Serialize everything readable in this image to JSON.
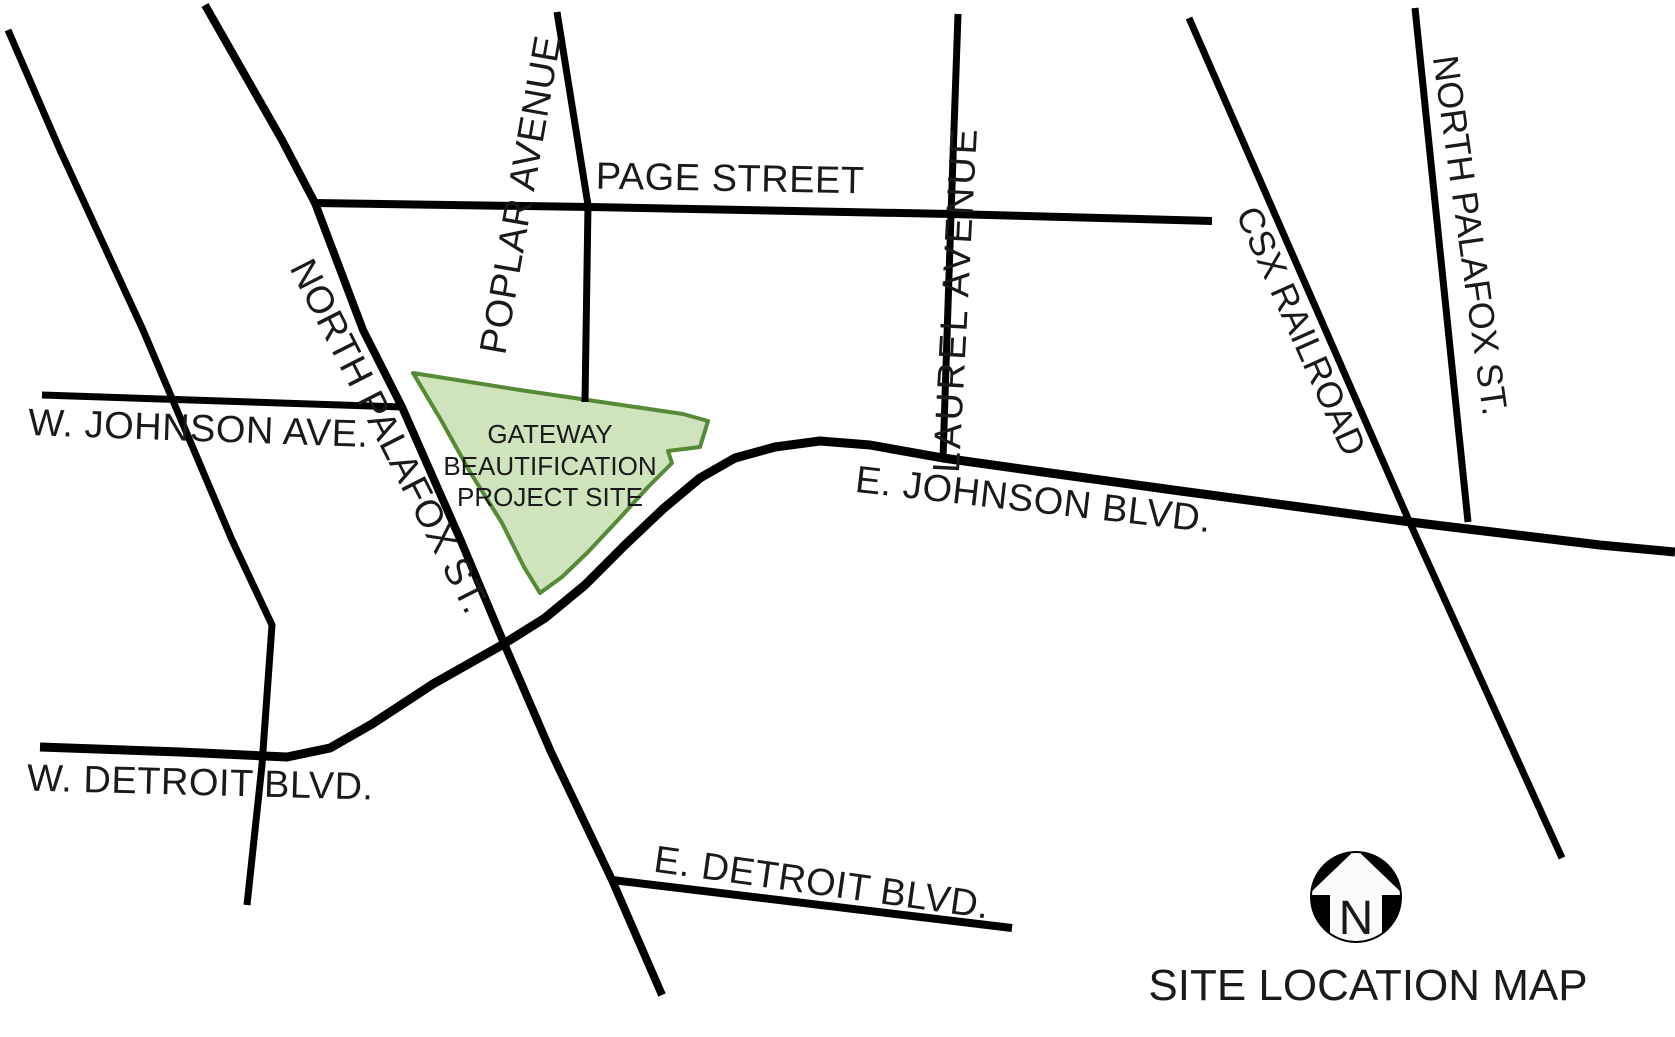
{
  "map": {
    "title": "SITE LOCATION MAP",
    "compass": {
      "letter": "N",
      "name": "north-arrow"
    },
    "site": {
      "line1": "GATEWAY",
      "line2": "BEAUTIFICATION",
      "line3": "PROJECT SITE"
    },
    "streets": {
      "page": "PAGE STREET",
      "poplar": "POPLAR AVENUE",
      "laurel": "LAUREL AVENUE",
      "csx": "CSX RAILROAD",
      "north_palafox_west": "NORTH PALAFOX ST.",
      "north_palafox_east": "NORTH PALAFOX ST.",
      "w_johnson": "W. JOHNSON AVE.",
      "e_johnson": "E. JOHNSON BLVD.",
      "w_detroit": "W. DETROIT BLVD.",
      "e_detroit": "E. DETROIT BLVD."
    },
    "colors": {
      "background": "#ffffff",
      "road": "#000000",
      "text": "#1a1a1a",
      "site_fill": "#cfe3bc",
      "site_stroke": "#568a36",
      "compass_fill": "#000000",
      "compass_arrow": "#fafafa"
    }
  }
}
